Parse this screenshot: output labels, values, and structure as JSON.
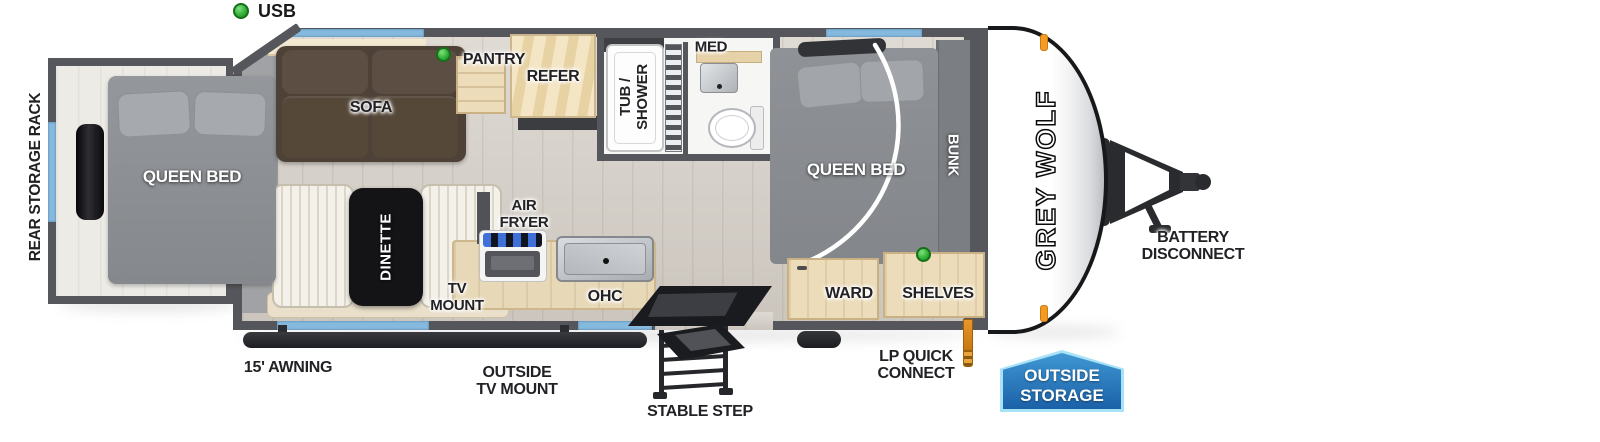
{
  "legend": {
    "usb": "USB"
  },
  "brand": {
    "logo": "GREY WOLF"
  },
  "plan": {
    "rear_storage_rack": "REAR STORAGE RACK",
    "rear_queen_bed": "QUEEN BED",
    "sofa": "SOFA",
    "pantry": "PANTRY",
    "refer": "REFER",
    "tub_shower": {
      "l1": "TUB /",
      "l2": "SHOWER"
    },
    "med": "MED",
    "front_queen_bed": "QUEEN BED",
    "bunk": "BUNK",
    "dinette": "DINETTE",
    "tv_mount": {
      "l1": "TV",
      "l2": "MOUNT"
    },
    "air_fryer": {
      "l1": "AIR",
      "l2": "FRYER"
    },
    "ohc": "OHC",
    "ward": "WARD",
    "shelves": "SHELVES"
  },
  "exterior": {
    "awning": "15' AWNING",
    "outside_tv": {
      "l1": "OUTSIDE",
      "l2": "TV MOUNT"
    },
    "stable_step": "STABLE STEP",
    "lp_quick_connect": {
      "l1": "LP QUICK",
      "l2": "CONNECT"
    },
    "battery": {
      "l1": "BATTERY",
      "l2": "DISCONNECT"
    }
  },
  "badge": {
    "l1": "OUTSIDE",
    "l2": "STORAGE"
  },
  "colors": {
    "wall": "#56575c",
    "floor": "#d6d0c8",
    "window_blue": "#86b9de",
    "bed_gray": "#898c90",
    "sofa_brown": "#4e4238",
    "wood_light": "#ecdcba",
    "usb_green": "#2fae34",
    "awning_dark": "#26272b",
    "lp_orange": "#e08a1f",
    "badge_blue": "#1b63ab",
    "badge_border": "#a8e2f7",
    "cap_white": "#ffffff"
  }
}
